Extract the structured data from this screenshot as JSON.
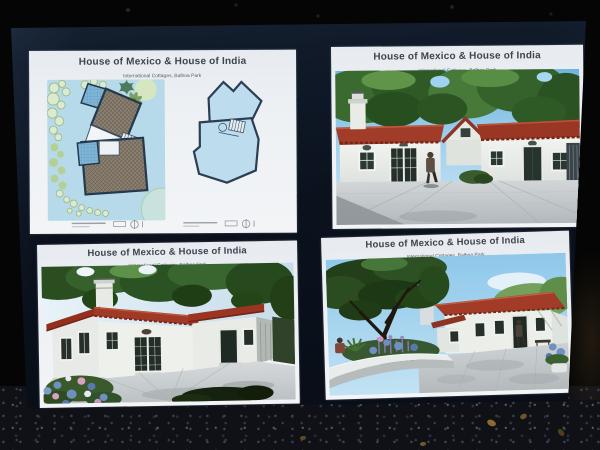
{
  "photo": {
    "subject": "Black presentation board displayed outdoors holding four white architectural presentation sheets",
    "setting": "dark background above, speckled asphalt ground below the board",
    "board_color": "#0c121d",
    "background_color": "#050505",
    "ground_color": "#101116"
  },
  "panels": [
    {
      "id": "floor-plans",
      "title": "House of Mexico & House of India",
      "subtitle": "International Cottages, Balboa Park",
      "content": "site plan with landscaping beside an upper floor plan, small caption blocks with scale bars and north arrows"
    },
    {
      "id": "rendering-front",
      "title": "House of Mexico & House of India",
      "subtitle": "International Cottages, Balboa Park",
      "content": "3D rendering: white stucco cottage with red tile roof, chimney, trees behind, person walking on plaza"
    },
    {
      "id": "rendering-angled",
      "title": "House of Mexico & House of India",
      "subtitle": "International Cottages, Balboa Park",
      "content": "3D rendering: angled view of cottage with french doors, flower bed of blue and pink blooms at left"
    },
    {
      "id": "rendering-garden",
      "title": "House of Mexico & House of India",
      "subtitle": "International Cottages, Balboa Park",
      "content": "3D rendering: large tree and curved white planter with purple flowers, cottage at right with people"
    }
  ],
  "colors": {
    "panel_white": "#eef1f4",
    "title_text": "#3d444c",
    "plan_background_blue": "#b7daea",
    "plan_wall_outline": "#24384e",
    "plan_hatch_fill": "#8e8273",
    "plan_tile_blue": "#7fb6d7",
    "landscape_green": "#b4d095",
    "roof_red": "#a03a26",
    "stucco_white": "#eceeea",
    "door_dark_teal": "#27332d",
    "tree_green_dark": "#2b5222",
    "plaza_gray": "#c6cbce",
    "flower_blue": "#6f8fc0",
    "flower_pink": "#d7a2c4",
    "flower_purple": "#8a74b8"
  }
}
